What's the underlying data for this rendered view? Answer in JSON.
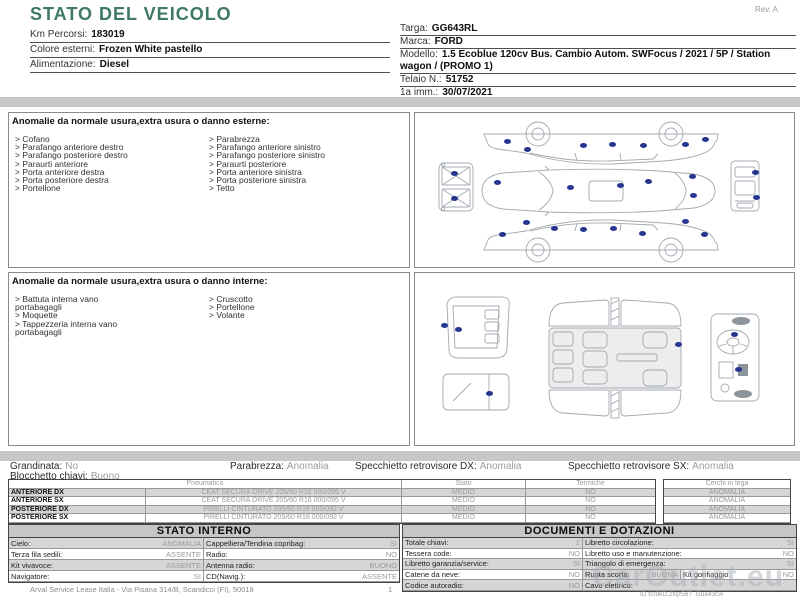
{
  "meta": {
    "rev": "Rev. A"
  },
  "title": "STATO DEL VEICOLO",
  "header_left": [
    {
      "label": "Km Percorsi:",
      "value": "183019"
    },
    {
      "label": "Colore esterni:",
      "value": "Frozen White pastello"
    },
    {
      "label": "Alimentazione:",
      "value": "Diesel"
    }
  ],
  "header_right": [
    {
      "label": "Targa:",
      "value": "GG643RL"
    },
    {
      "label": "Marca:",
      "value": "FORD"
    },
    {
      "label": "Modello:",
      "value": "1.5 Ecoblue 120cv Bus. Cambio Autom. SWFocus / 2021 / 5P / Station wagon / (PROMO 1)"
    },
    {
      "label": "Telaio N.:",
      "value": "51752"
    },
    {
      "label": "1a imm.:",
      "value": "30/07/2021"
    }
  ],
  "exterior": {
    "heading": "Anomalie da normale usura,extra usura o danno esterne:",
    "col1": [
      "Cofano",
      "Parafango anteriore destro",
      "Parafango posteriore destro",
      "Paraurti anteriore",
      "Porta anteriore destra",
      "Porta posteriore destra",
      "Portellone"
    ],
    "col2": [
      "Parabrezza",
      "Parafango anteriore sinistro",
      "Parafango posteriore sinistro",
      "Paraurti posteriore",
      "Porta anteriore sinistra",
      "Porta posteriore sinistra",
      "Tetto"
    ],
    "dots": [
      [
        92,
        28
      ],
      [
        112,
        36
      ],
      [
        168,
        32
      ],
      [
        197,
        31
      ],
      [
        228,
        32
      ],
      [
        270,
        31
      ],
      [
        290,
        26
      ],
      [
        39,
        60
      ],
      [
        39,
        85
      ],
      [
        82,
        69
      ],
      [
        155,
        74
      ],
      [
        205,
        72
      ],
      [
        233,
        68
      ],
      [
        277,
        63
      ],
      [
        278,
        82
      ],
      [
        340,
        59
      ],
      [
        341,
        84
      ],
      [
        111,
        109
      ],
      [
        139,
        115
      ],
      [
        168,
        116
      ],
      [
        198,
        115
      ],
      [
        227,
        120
      ],
      [
        270,
        108
      ],
      [
        87,
        121
      ],
      [
        289,
        121
      ]
    ]
  },
  "interior": {
    "heading": "Anomalie da normale usura,extra usura o danno interne:",
    "col1": [
      "Battuta interna vano portabagagli",
      "Moquette",
      "Tappezzeria interna vano portabagagli"
    ],
    "col2": [
      "Cruscotto",
      "Portellone",
      "Volante"
    ],
    "dots": [
      [
        29,
        52
      ],
      [
        43,
        56
      ],
      [
        263,
        71
      ],
      [
        319,
        61
      ],
      [
        323,
        96
      ],
      [
        74,
        120
      ]
    ]
  },
  "summary": {
    "grandinata_label": "Grandinata:",
    "grandinata_value": "No",
    "blocchetto_label": "Blocchetto chiavi:",
    "blocchetto_value": "Buono",
    "parabrezza_label": "Parabrezza:",
    "parabrezza_value": "Anomalia",
    "specchietto_dx_label": "Specchietto retrovisore DX:",
    "specchietto_dx_value": "Anomalia",
    "specchietto_sx_label": "Specchietto retrovisore SX:",
    "specchietto_sx_value": "Anomalia"
  },
  "tyres": {
    "headers": {
      "pneumatico": "Pneumatico",
      "stato": "Stato",
      "termiche": "Termiche",
      "cerchi": "Cerchi in lega"
    },
    "rows": [
      {
        "position": "ANTERIORE DX",
        "tyre": "CEAT SECURA DRIVE 205/60 R16 000/095 V",
        "stato": "MEDIO",
        "termiche": "NO",
        "cerchi": "ANOMALIA"
      },
      {
        "position": "ANTERIORE SX",
        "tyre": "CEAT SECURA DRIVE 205/60 R16 000/095 V",
        "stato": "MEDIO",
        "termiche": "NO",
        "cerchi": "ANOMALIA"
      },
      {
        "position": "POSTERIORE DX",
        "tyre": "PIRELLI CINTURATO 205/60 R16 000/092 V",
        "stato": "MEDIO",
        "termiche": "NO",
        "cerchi": "ANOMALIA"
      },
      {
        "position": "POSTERIORE SX",
        "tyre": "PIRELLI CINTURATO 205/60 R16 000/092 V",
        "stato": "MEDIO",
        "termiche": "NO",
        "cerchi": "ANOMALIA"
      }
    ]
  },
  "stato_interno": {
    "title": "STATO INTERNO",
    "rows": [
      [
        {
          "label": "Cielo:",
          "value": "ANOMALIA"
        },
        {
          "label": "Cappelliera/Tendina copribag:",
          "value": "SI"
        }
      ],
      [
        {
          "label": "Terza fila sedili:",
          "value": "ASSENTE"
        },
        {
          "label": "Radio:",
          "value": "NO"
        }
      ],
      [
        {
          "label": "Kit vivavoce:",
          "value": "ASSENTE"
        },
        {
          "label": "Antenna radio:",
          "value": "BUONO"
        }
      ],
      [
        {
          "label": "Navigatore:",
          "value": "SI"
        },
        {
          "label": "CD(Navig.):",
          "value": "ASSENTE"
        }
      ]
    ]
  },
  "documenti": {
    "title": "DOCUMENTI E DOTAZIONI",
    "rows": [
      [
        {
          "label": "Totale chiavi:",
          "value": "2"
        },
        {
          "label": "Libretto circolazione:",
          "value": "SI"
        }
      ],
      [
        {
          "label": "Tessera code:",
          "value": "NO"
        },
        {
          "label": "Libretto uso e manutenzione:",
          "value": "NO"
        }
      ],
      [
        {
          "label": "Libretto garanzia/service:",
          "value": "SI"
        },
        {
          "label": "Triangolo di emergenza:",
          "value": "SI"
        }
      ],
      [
        {
          "label": "Catene da neve:",
          "value": "NO"
        },
        {
          "label": "Ruota scorta:",
          "value": "BUONA"
        },
        {
          "label": "Kit gonfiaggio:",
          "value": "NO"
        }
      ],
      [
        {
          "label": "Codice autoradio:",
          "value": "NO"
        },
        {
          "label": "Cavo elettrico:",
          "value": ""
        }
      ]
    ]
  },
  "footer": {
    "company": "Arval Service Lease Italia - Via Pisana 314/B, Scandicci (FI), 50018",
    "page": "1",
    "id_note": "ID tcr9kD.2fqz567 .Gua43cw"
  },
  "watermark": "CarOutlet.eu",
  "colors": {
    "teal": "#3f7868",
    "bar_gray": "#c7c7c7",
    "dot_navy": "#26368f",
    "value_gray": "#9b9b9b",
    "row_shade": "#d6d6d6"
  }
}
